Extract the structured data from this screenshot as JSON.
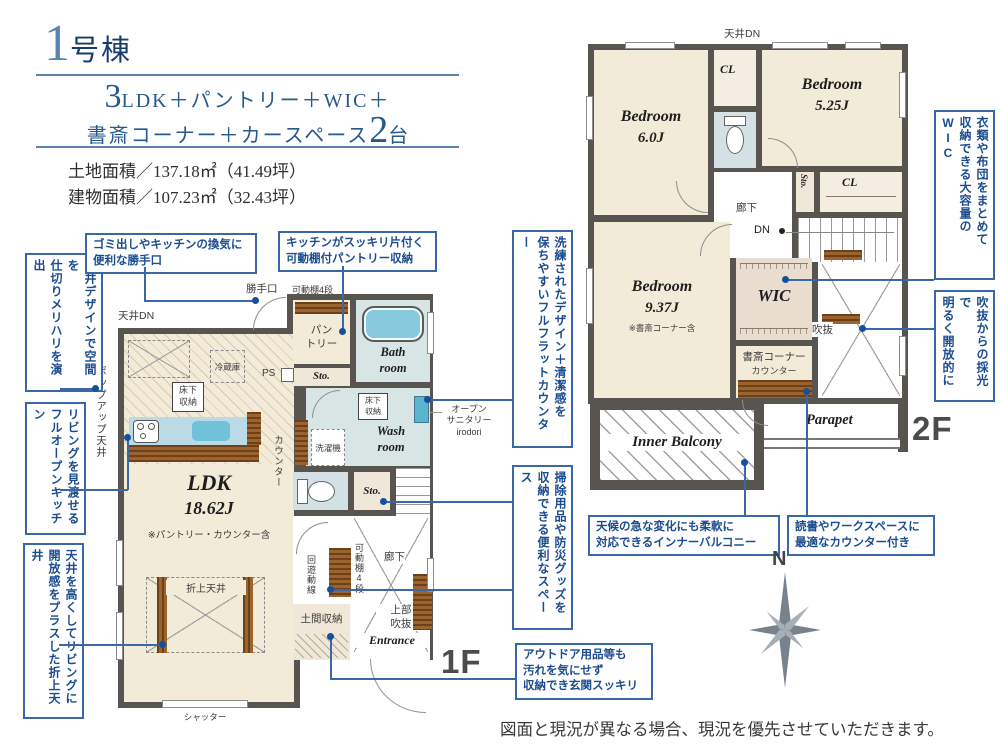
{
  "header": {
    "num": "1",
    "suffix": "号棟",
    "l1_big": "3",
    "l1_rest": "LDK＋パントリー＋WIC＋",
    "l2_main": "書斎コーナー＋カースペース",
    "l2_big": "2",
    "l2_tail": "台",
    "land": "土地面積／137.18㎡（41.49坪）",
    "building": "建物面積／107.23㎡（32.43坪）"
  },
  "f1": {
    "tag": "1F",
    "ceiling_dn": "天井DN",
    "popup": "ポップアップ天井",
    "fridge": "冷蔵庫",
    "underfloor": "床下\n収納",
    "ldk": "LDK",
    "ldk_size": "18.62J",
    "ldk_note": "※パントリー・カウンター含",
    "oriage": "折上天井",
    "shutter": "シャッター",
    "katteguchi": "勝手口",
    "shelf4": "可動棚4段",
    "pantry": "パン\nトリー",
    "ps": "PS",
    "sto": "Sto.",
    "bath": "Bath\nroom",
    "wash": "Wash\nroom",
    "washer": "洗濯機",
    "counter": "カウンター",
    "sanitary": "オープン\nサニタリー\nirodori",
    "up": "UP",
    "hall": "廊下",
    "kaiyu": "回遊動線",
    "doma": "土間収納",
    "void_upper": "上部\n吹抜",
    "entrance": "Entrance"
  },
  "f2": {
    "tag": "2F",
    "ceiling_dn": "天井DN",
    "bed6": "Bedroom",
    "bed6_size": "6.0J",
    "cl1": "CL",
    "counter": "カウンター",
    "bed525": "Bedroom",
    "bed525_size": "5.25J",
    "sto": "Sto.",
    "cl2": "CL",
    "hall": "廊下",
    "dn": "DN",
    "bed937": "Bedroom",
    "bed937_size": "9.37J",
    "bed937_note": "※書斎コーナー含",
    "wic": "WIC",
    "void": "吹抜",
    "study": "書斎コーナー",
    "study_counter": "カウンター",
    "balcony": "Inner Balcony",
    "parapet": "Parapet"
  },
  "callouts": {
    "c1": "天井デザインで空間を\n仕切りメリハリを演出",
    "c2": "リビングを見渡せる\nフルオープンキッチン",
    "c3": "天井を高くしてリビングに\n開放感をプラスした折上天井",
    "c4": "ゴミ出しやキッチンの換気に\n便利な勝手口",
    "c5": "キッチンがスッキリ片付く\n可動棚付パントリー収納",
    "c6": "洗練されたデザイン＋清潔感を\n保ちやすいフルフラットカウンター",
    "c7": "掃除用品や防災グッズを\n収納できる便利なスペース",
    "c8": "アウトドア用品等も\n汚れを気にせず\n収納でき玄関スッキリ",
    "c9": "天候の急な変化にも柔軟に\n対応できるインナーバルコニー",
    "c10": "読書やワークスペースに\n最適なカウンター付き",
    "c11": "衣類や布団をまとめて\n収納できる大容量のWIC",
    "c12": "吹抜からの採光で\n明るく開放的に"
  },
  "compass": {
    "n": "N"
  },
  "disclaimer": "図面と現況が異なる場合、現況を優先させていただきます。"
}
